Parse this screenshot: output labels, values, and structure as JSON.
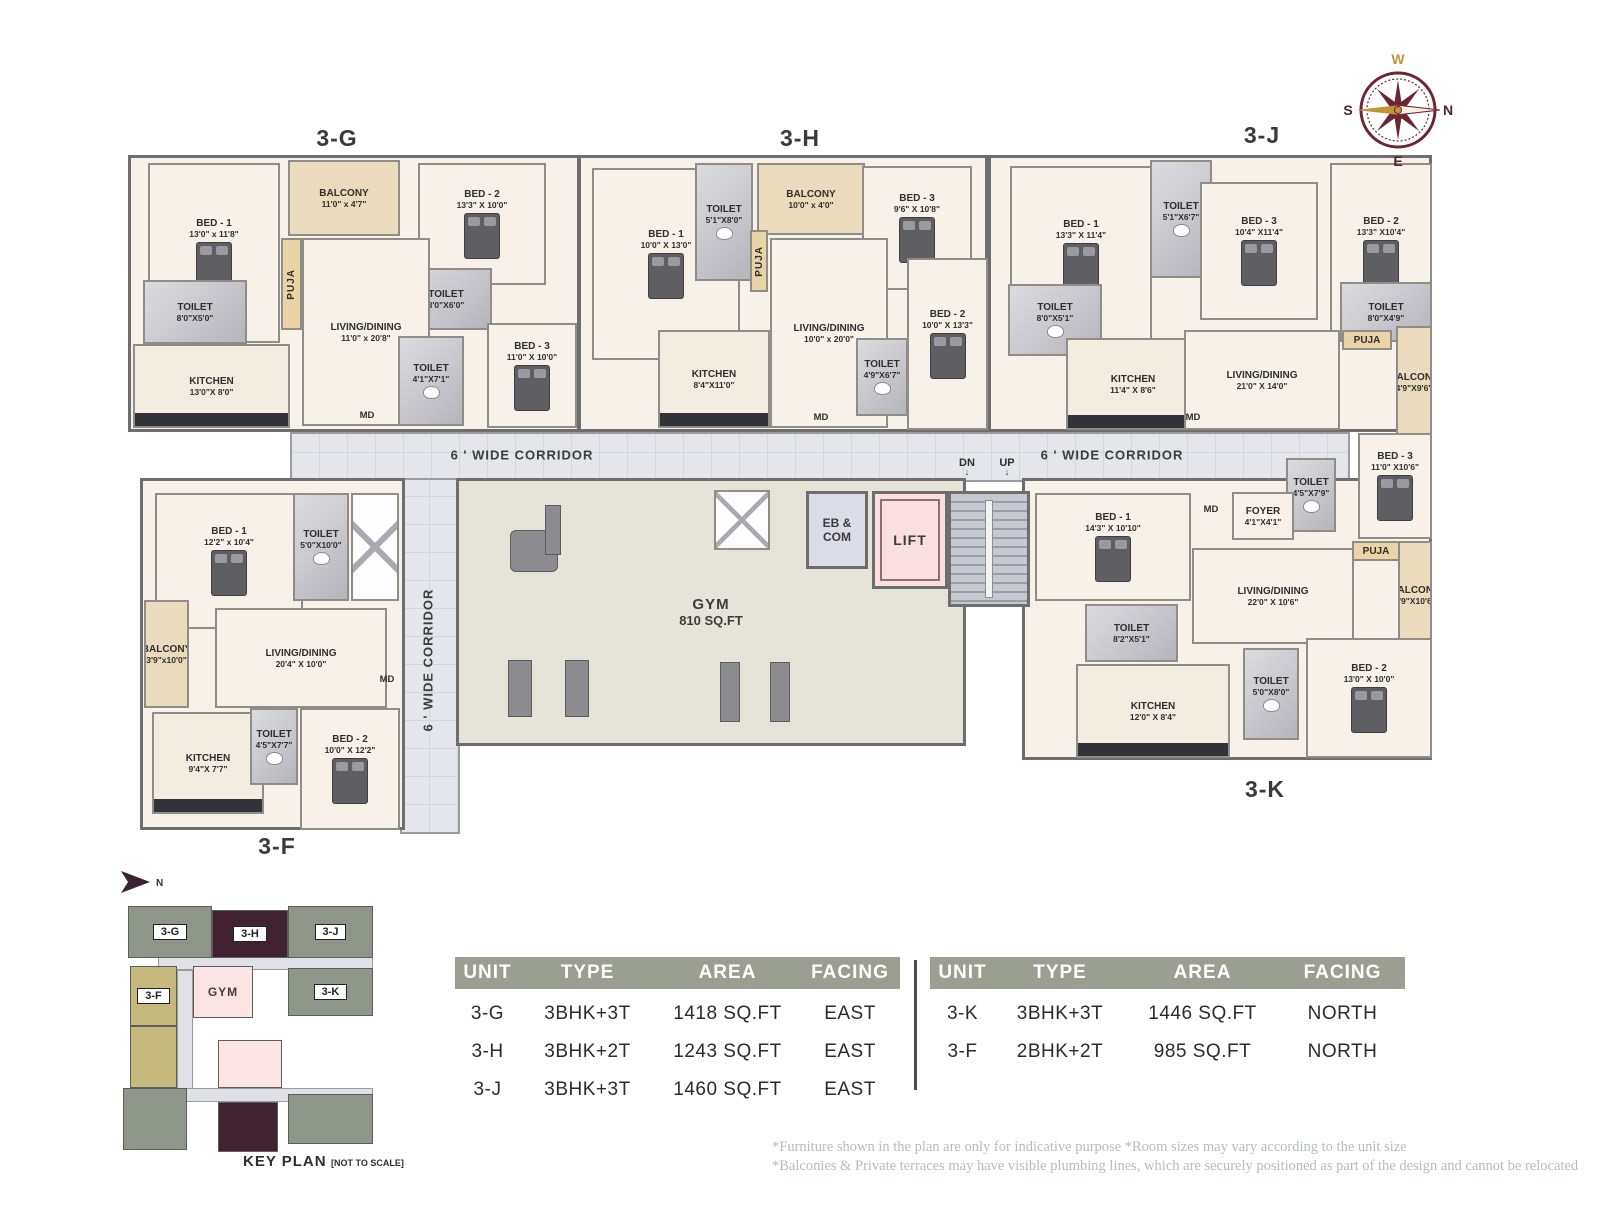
{
  "plan": {
    "corridor_label": "6 ' WIDE CORRIDOR",
    "gym": {
      "name": "GYM",
      "area": "810 SQ.FT"
    },
    "eb_com": "EB & COM",
    "lift": "LIFT",
    "stairs": {
      "dn": "DN",
      "up": "UP"
    },
    "units": [
      {
        "id": "3-G",
        "label_pos": [
          337,
          125
        ],
        "block": [
          128,
          155,
          452,
          277
        ],
        "rooms": [
          {
            "name": "BED - 1",
            "dim": "13'0\" x 11'8\"",
            "type": "bed",
            "rect": [
              148,
              163,
              132,
              180
            ]
          },
          {
            "name": "BALCONY",
            "dim": "11'0\" x 4'7\"",
            "type": "balcony",
            "rect": [
              288,
              160,
              112,
              76
            ]
          },
          {
            "name": "PUJA",
            "dim": "",
            "type": "puja",
            "vertical": true,
            "rect": [
              281,
              238,
              21,
              92
            ]
          },
          {
            "name": "BED - 2",
            "dim": "13'3\" X 10'0\"",
            "type": "bed",
            "rect": [
              418,
              163,
              128,
              122
            ]
          },
          {
            "name": "TOILET",
            "dim": "8'0\"X5'0\"",
            "type": "toilet",
            "rect": [
              143,
              280,
              104,
              64
            ]
          },
          {
            "name": "TOILET",
            "dim": "8'0\"X6'0\"",
            "type": "toilet",
            "rect": [
              400,
              268,
              92,
              62
            ]
          },
          {
            "name": "LIVING/DINING",
            "dim": "11'0\" x 20'8\"",
            "type": "living",
            "rect": [
              302,
              238,
              128,
              188
            ]
          },
          {
            "name": "KITCHEN",
            "dim": "13'0\"X 8'0\"",
            "type": "kitchen",
            "rect": [
              133,
              344,
              157,
              84
            ]
          },
          {
            "name": "BED - 3",
            "dim": "11'0\" X 10'0\"",
            "type": "bed",
            "rect": [
              487,
              323,
              90,
              105
            ]
          },
          {
            "name": "TOILET",
            "dim": "4'1\"X7'1\"",
            "type": "toilet",
            "rect": [
              398,
              336,
              66,
              90
            ]
          },
          {
            "name": "MD",
            "dim": "",
            "type": "md",
            "rect": [
              352,
              406,
              30,
              18
            ]
          }
        ]
      },
      {
        "id": "3-H",
        "label_pos": [
          800,
          125
        ],
        "block": [
          578,
          155,
          410,
          277
        ],
        "rooms": [
          {
            "name": "BED - 1",
            "dim": "10'0\" X 13'0\"",
            "type": "bed",
            "rect": [
              592,
              168,
              148,
              192
            ]
          },
          {
            "name": "TOILET",
            "dim": "5'1\"X8'0\"",
            "type": "toilet",
            "rect": [
              695,
              163,
              58,
              118
            ]
          },
          {
            "name": "BALCONY",
            "dim": "10'0\" x 4'0\"",
            "type": "balcony",
            "rect": [
              757,
              163,
              108,
              72
            ]
          },
          {
            "name": "PUJA",
            "dim": "",
            "type": "puja",
            "vertical": true,
            "rect": [
              750,
              230,
              18,
              62
            ]
          },
          {
            "name": "BED - 3",
            "dim": "9'6\" X 10'8\"",
            "type": "bed",
            "rect": [
              862,
              166,
              110,
              124
            ]
          },
          {
            "name": "LIVING/DINING",
            "dim": "10'0\" x 20'0\"",
            "type": "living",
            "rect": [
              770,
              238,
              118,
              190
            ]
          },
          {
            "name": "KITCHEN",
            "dim": "8'4\"X11'0\"",
            "type": "kitchen",
            "rect": [
              658,
              330,
              112,
              98
            ]
          },
          {
            "name": "TOILET",
            "dim": "4'9\"X6'7\"",
            "type": "toilet",
            "rect": [
              856,
              338,
              52,
              78
            ]
          },
          {
            "name": "BED - 2",
            "dim": "10'0\" X 13'3\"",
            "type": "bed",
            "rect": [
              907,
              258,
              81,
              172
            ]
          },
          {
            "name": "MD",
            "dim": "",
            "type": "md",
            "rect": [
              806,
              408,
              30,
              18
            ]
          }
        ]
      },
      {
        "id": "3-J",
        "label_pos": [
          1262,
          122
        ],
        "block": [
          988,
          155,
          444,
          277
        ],
        "rooms": [
          {
            "name": "BED - 1",
            "dim": "13'3\" X 11'4\"",
            "type": "bed",
            "rect": [
              1010,
              166,
              142,
              176
            ]
          },
          {
            "name": "TOILET",
            "dim": "5'1\"X6'7\"",
            "type": "toilet",
            "rect": [
              1150,
              160,
              62,
              118
            ]
          },
          {
            "name": "BED - 3",
            "dim": "10'4\" X11'4\"",
            "type": "bed",
            "rect": [
              1200,
              182,
              118,
              138
            ]
          },
          {
            "name": "BED - 2",
            "dim": "13'3\" X10'4\"",
            "type": "bed",
            "rect": [
              1330,
              163,
              102,
              176
            ]
          },
          {
            "name": "TOILET",
            "dim": "8'0\"X5'1\"",
            "type": "toilet",
            "rect": [
              1008,
              284,
              94,
              72
            ]
          },
          {
            "name": "TOILET",
            "dim": "8'0\"X4'9\"",
            "type": "toilet",
            "rect": [
              1340,
              282,
              92,
              60
            ]
          },
          {
            "name": "PUJA",
            "dim": "",
            "type": "puja",
            "rect": [
              1342,
              330,
              50,
              20
            ]
          },
          {
            "name": "KITCHEN",
            "dim": "11'4\" X 8'6\"",
            "type": "kitchen",
            "rect": [
              1066,
              338,
              134,
              92
            ]
          },
          {
            "name": "LIVING/DINING",
            "dim": "21'0\" X 14'0\"",
            "type": "living",
            "rect": [
              1184,
              330,
              156,
              100
            ]
          },
          {
            "name": "BALCONY",
            "dim": "4'9\"X9'6\"",
            "type": "balcony",
            "vertical": false,
            "rect": [
              1396,
              326,
              36,
              112
            ]
          },
          {
            "name": "MD",
            "dim": "",
            "type": "md",
            "rect": [
              1178,
              408,
              30,
              18
            ]
          }
        ]
      },
      {
        "id": "3-K",
        "label_pos": [
          1265,
          776
        ],
        "block": [
          1022,
          478,
          410,
          282
        ],
        "rooms": [
          {
            "name": "TOILET",
            "dim": "4'5\"X7'9\"",
            "type": "toilet",
            "rect": [
              1286,
              458,
              50,
              74
            ]
          },
          {
            "name": "FOYER",
            "dim": "4'1\"X4'1\"",
            "type": "foyer",
            "rect": [
              1232,
              492,
              62,
              48
            ]
          },
          {
            "name": "MD",
            "dim": "",
            "type": "md",
            "rect": [
              1196,
              500,
              30,
              18
            ]
          },
          {
            "name": "BED - 3",
            "dim": "11'0\" X10'6\"",
            "type": "bed",
            "rect": [
              1358,
              433,
              74,
              106
            ]
          },
          {
            "name": "PUJA",
            "dim": "",
            "type": "puja",
            "rect": [
              1352,
              541,
              48,
              20
            ]
          },
          {
            "name": "BALCONY",
            "dim": "4'9\"X10'6\"",
            "type": "balcony",
            "rect": [
              1398,
              541,
              34,
              108
            ]
          },
          {
            "name": "BED - 1",
            "dim": "14'3\" X 10'10\"",
            "type": "bed",
            "rect": [
              1035,
              493,
              156,
              108
            ]
          },
          {
            "name": "TOILET",
            "dim": "8'2\"X5'1\"",
            "type": "toilet",
            "rect": [
              1085,
              604,
              93,
              58
            ]
          },
          {
            "name": "LIVING/DINING",
            "dim": "22'0\" X 10'6\"",
            "type": "living",
            "rect": [
              1192,
              548,
              162,
              96
            ]
          },
          {
            "name": "TOILET",
            "dim": "5'0\"X8'0\"",
            "type": "toilet",
            "rect": [
              1243,
              648,
              56,
              92
            ]
          },
          {
            "name": "BED - 2",
            "dim": "13'0\" X 10'0\"",
            "type": "bed",
            "rect": [
              1306,
              638,
              126,
              120
            ]
          },
          {
            "name": "KITCHEN",
            "dim": "12'0\" X 8'4\"",
            "type": "kitchen",
            "rect": [
              1076,
              664,
              154,
              94
            ]
          }
        ]
      },
      {
        "id": "3-F",
        "label_pos": [
          277,
          833
        ],
        "block": [
          140,
          478,
          265,
          352
        ],
        "rooms": [
          {
            "name": "BED - 1",
            "dim": "12'2\" x 10'4\"",
            "type": "bed",
            "rect": [
              155,
              493,
              148,
              136
            ]
          },
          {
            "name": "TOILET",
            "dim": "5'0\"X10'0\"",
            "type": "toilet",
            "rect": [
              293,
              493,
              56,
              108
            ]
          },
          {
            "name": "",
            "dim": "",
            "type": "shaft",
            "rect": [
              351,
              493,
              48,
              108
            ]
          },
          {
            "name": "BALCONY",
            "dim": "3'9\"x10'0\"",
            "type": "balcony",
            "rect": [
              144,
              600,
              45,
              108
            ]
          },
          {
            "name": "LIVING/DINING",
            "dim": "20'4\" X 10'0\"",
            "type": "living",
            "rect": [
              215,
              608,
              172,
              100
            ]
          },
          {
            "name": "KITCHEN",
            "dim": "9'4\"X 7'7\"",
            "type": "kitchen",
            "rect": [
              152,
              712,
              112,
              102
            ]
          },
          {
            "name": "TOILET",
            "dim": "4'5\"X7'7\"",
            "type": "toilet",
            "rect": [
              250,
              708,
              48,
              77
            ]
          },
          {
            "name": "BED - 2",
            "dim": "10'0\" X 12'2\"",
            "type": "bed",
            "rect": [
              300,
              708,
              100,
              122
            ]
          },
          {
            "name": "MD",
            "dim": "",
            "type": "md",
            "rect": [
              372,
              670,
              30,
              18
            ]
          }
        ]
      }
    ]
  },
  "compass": {
    "top": "W",
    "bottom": "E",
    "left": "S",
    "right": "N"
  },
  "key_plan": {
    "title": "KEY PLAN",
    "subtitle": "[NOT TO SCALE]",
    "north_label": "N",
    "blocks": [
      {
        "label": "",
        "color": "corridor",
        "rect": [
          158,
          956,
          215,
          14
        ]
      },
      {
        "label": "",
        "color": "corridor",
        "rect": [
          177,
          970,
          16,
          126
        ]
      },
      {
        "label": "",
        "color": "corridor",
        "rect": [
          158,
          1088,
          215,
          14
        ]
      },
      {
        "label": "3-G",
        "color": "green",
        "chip": true,
        "rect": [
          128,
          906,
          84,
          52
        ]
      },
      {
        "label": "3-H",
        "color": "maroon",
        "chip": true,
        "rect": [
          212,
          910,
          76,
          48
        ]
      },
      {
        "label": "3-J",
        "color": "green",
        "chip": true,
        "rect": [
          288,
          906,
          85,
          52
        ]
      },
      {
        "label": "GYM",
        "color": "pink",
        "chip": false,
        "rect": [
          193,
          966,
          60,
          52
        ]
      },
      {
        "label": "3-K",
        "color": "green",
        "chip": true,
        "rect": [
          288,
          968,
          85,
          48
        ]
      },
      {
        "label": "3-F",
        "color": "khaki",
        "chip": true,
        "rect": [
          130,
          966,
          47,
          60
        ]
      },
      {
        "label": "",
        "color": "khaki",
        "rect": [
          130,
          1026,
          47,
          62
        ]
      },
      {
        "label": "",
        "color": "pink",
        "rect": [
          218,
          1040,
          64,
          48
        ]
      },
      {
        "label": "",
        "color": "green",
        "rect": [
          123,
          1088,
          64,
          62
        ]
      },
      {
        "label": "",
        "color": "maroon",
        "rect": [
          218,
          1102,
          60,
          50
        ]
      },
      {
        "label": "",
        "color": "green",
        "rect": [
          288,
          1094,
          85,
          50
        ]
      }
    ]
  },
  "unit_table": {
    "headers": [
      "UNIT",
      "TYPE",
      "AREA",
      "FACING"
    ],
    "left_rows": [
      [
        "3-G",
        "3BHK+3T",
        "1418 SQ.FT",
        "EAST"
      ],
      [
        "3-H",
        "3BHK+2T",
        "1243 SQ.FT",
        "EAST"
      ],
      [
        "3-J",
        "3BHK+3T",
        "1460 SQ.FT",
        "EAST"
      ]
    ],
    "right_rows": [
      [
        "3-K",
        "3BHK+3T",
        "1446 SQ.FT",
        "NORTH"
      ],
      [
        "3-F",
        "2BHK+2T",
        "985 SQ.FT",
        "NORTH"
      ]
    ]
  },
  "disclaimers": [
    "*Furniture shown in the plan are only for indicative purpose *Room sizes may vary according to the unit size",
    "*Balconies & Private terraces may have visible plumbing lines, which are securely positioned as part of the design and cannot be relocated"
  ],
  "colors": {
    "wall": "#6e6e6e",
    "unit_bg": "#f7f1e9",
    "toilet_bg": "#c9c9cf",
    "balcony_bg": "#eadbbc",
    "puja_bg": "#e8d4a4",
    "kitchen_bg": "#f3ece0",
    "corridor_bg": "#e4e6eb",
    "gym_bg": "#e6e4d8",
    "lift_bg": "#fadfe1",
    "ebcom_bg": "#dcdce8",
    "stairs_bg": "#b9bdc5",
    "table_header_bg": "#9b9f91",
    "keyplan_green": "#8e968a",
    "keyplan_maroon": "#402231",
    "keyplan_khaki": "#c5b97d",
    "keyplan_pink": "#fbe4e4",
    "compass_maroon": "#6b2535",
    "compass_gold": "#bf9537",
    "text_dark": "#3a3a3a",
    "disclaimer_text": "#b5bbc5"
  }
}
